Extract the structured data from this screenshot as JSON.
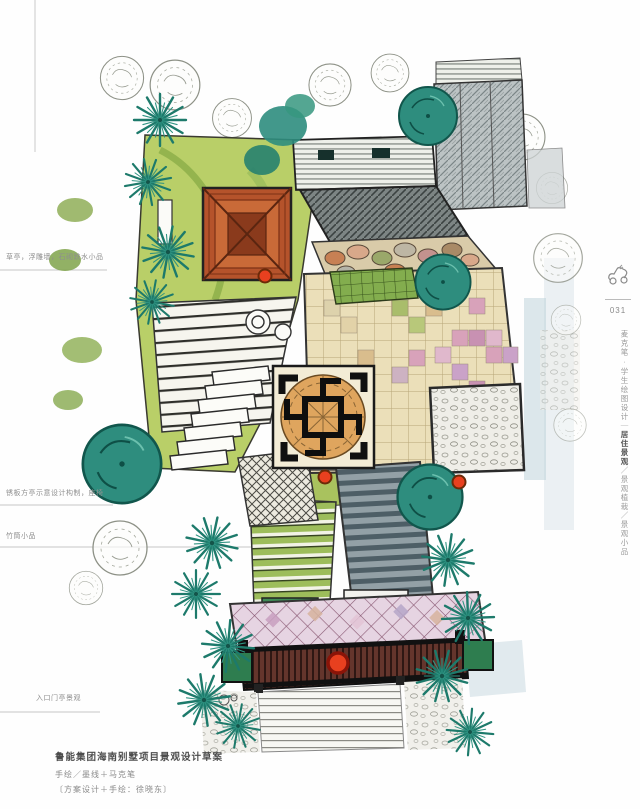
{
  "annotations": [
    {
      "text": "草亭，浮雕墙，石砌跌水小品"
    },
    {
      "text": "锈板方亭示意设计构制，座椅"
    },
    {
      "text": "竹筒小品"
    },
    {
      "text": "入口门亭景观"
    }
  ],
  "caption": {
    "title": "鲁能集团海南别墅项目景观设计草案",
    "line2": "手绘／墨线＋马克笔",
    "line3": "〔方案设计＋手绘：徐晓东〕"
  },
  "sidebar": {
    "page_number": "031",
    "series": "麦克笔·学生绘图设计｜",
    "section_current": "居住景观",
    "sections_rest": "／景观植栽／景观小品",
    "icon": "sketch-doodle-icon"
  },
  "plan": {
    "type": "hand-drawn landscape plan",
    "markers": "red location dots",
    "colors": {
      "teal_tree": "#2e8d7e",
      "lawn": "#b9cf68",
      "pavilion_roof": "#b5532b",
      "plaza_tile": "#ebdfb9",
      "pink_tile": "#d8a2ba",
      "gate": "#64352c",
      "marker_red": "#e8401f",
      "shadow_blue": "#b9cfd8"
    }
  }
}
